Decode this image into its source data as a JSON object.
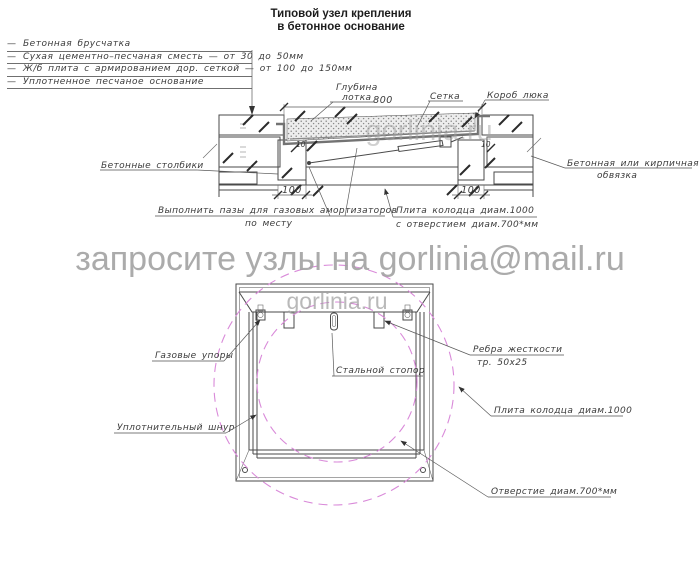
{
  "title": {
    "line1": "Типовой узел крепления",
    "line2": "в бетонное основание"
  },
  "legend": {
    "marker": "—",
    "items": [
      "Бетонная брусчатка",
      "Сухая цементно–песчаная сместь — от 30 до 50мм",
      "Ж/б плита с армированием дор. сеткой — от 100 до 150мм",
      "Уплотненное песчаное основание"
    ]
  },
  "section": {
    "labels": {
      "depth_line1": "Глубина",
      "depth_line2": "лотка",
      "mesh": "Сетка",
      "hatch_box": "Короб люка",
      "columns": "Бетонные столбики",
      "edging_line1": "Бетонная или кирпичная",
      "edging_line2": "обвязка",
      "grooves_line1": "Выполнить пазы для газовых амортизаторов",
      "grooves_line2": "по месту",
      "slab_line1": "Плита колодца диам.1000",
      "slab_line2": "с отверстием диам.700*мм"
    },
    "dims": {
      "width": "800",
      "col_left": "100",
      "col_right": "100",
      "gap_left": "10",
      "gap_right": "10"
    }
  },
  "plan": {
    "labels": {
      "gas_struts": "Газовые упоры",
      "steel_stopper": "Стальной стопор",
      "ribs_line1": "Ребра жесткости",
      "ribs_line2": "тр. 50х25",
      "slab": "Плита колодца диам.1000",
      "seal_cord": "Уплотнительный шнур",
      "opening": "Отверстие диам.700*мм"
    }
  },
  "watermarks": {
    "email": "запросите узлы на gorlinia@mail.ru",
    "site": "gorlinia.ru"
  },
  "colors": {
    "line": "#4a4a4a",
    "label": "#3b3b3b",
    "watermark": "#a2a2a2",
    "dashed_circle": "#d98ad9"
  }
}
